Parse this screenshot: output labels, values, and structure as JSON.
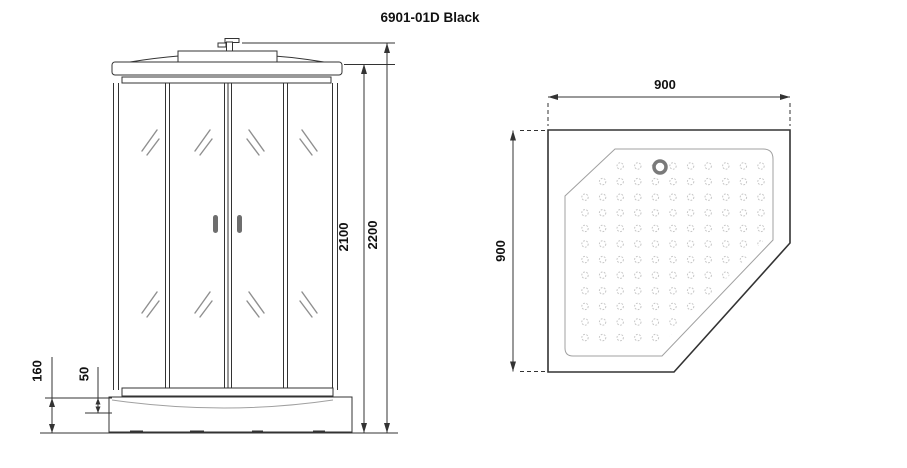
{
  "title": "6901-01D Black",
  "front_view": {
    "label": "shower cabin front view",
    "dims": {
      "total_height": "2200",
      "cabin_height": "2100",
      "tray_height": "160",
      "tray_depth": "50"
    }
  },
  "top_view": {
    "label": "shower tray top view",
    "dims": {
      "width": "900",
      "depth": "900"
    },
    "dot_grid": {
      "cols": 11,
      "rows": 12,
      "x0": 585,
      "y0": 166,
      "dx": 17.6,
      "dy": 15.6,
      "r": 3.2
    }
  },
  "colors": {
    "line": "#333333",
    "light_line": "#a0a0a0",
    "dots": "#c6c6c6",
    "drain": "#7a7a7a",
    "handle": "#6e6e6e",
    "hatch": "#8f8f8f",
    "background": "#ffffff",
    "text": "#111111"
  }
}
